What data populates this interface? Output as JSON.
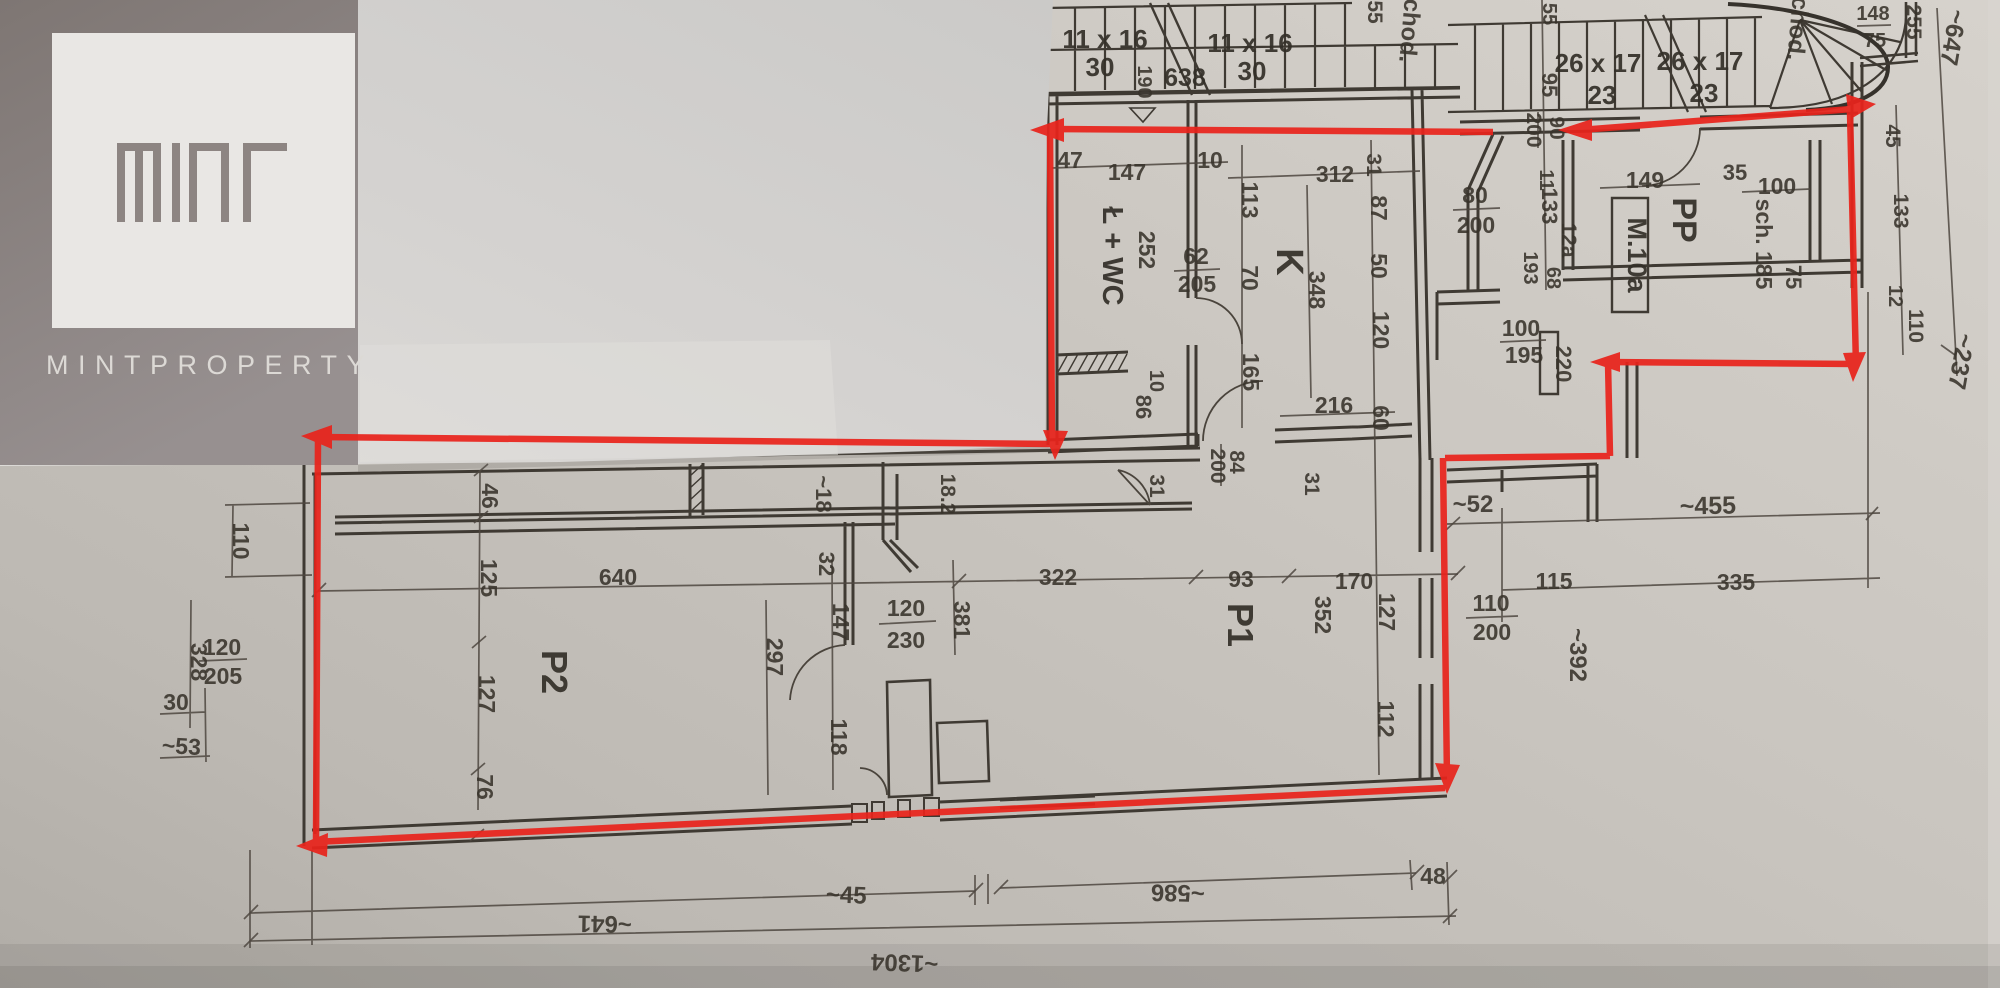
{
  "brand": {
    "wordmark": "MINTPROPERTY",
    "logo_name": "MINT"
  },
  "colors": {
    "annotation_red": "#e8241c",
    "ink": "#38332b",
    "paper": "#c8c4be",
    "overlay_sheet": "#d5d3d0",
    "logo_backdrop": "#8b8280",
    "logo_square": "#e9e7e4"
  },
  "plan": {
    "rooms": {
      "p1": "P1",
      "p2": "P2",
      "k": "K",
      "lwc": "Ł + WC",
      "pp": "PP",
      "m10a": "M.10a",
      "sch": "sch. 185"
    },
    "stairs": {
      "s11": "11 x 16",
      "t30": "30",
      "s26": "26 x 17",
      "t23": "23",
      "lvl": "638",
      "r190": "190",
      "chod": "chod."
    },
    "dims": {
      "d10": "10",
      "d11": "11",
      "d12": "12",
      "d12a": "12a",
      "d18": "~18",
      "d18_2": "18.2",
      "d30": "30",
      "d31": "31",
      "d32": "32",
      "d35": "35",
      "d45": "45",
      "d45b": "~45",
      "d46": "46",
      "d47": "47",
      "d48": "48",
      "d50": "50",
      "d52": "~52",
      "d53": "~53",
      "d55": "55",
      "d60": "60",
      "d62": "62",
      "d68": "68",
      "d70": "70",
      "d75": "75",
      "d76": "76",
      "d80": "80",
      "d84": "84",
      "d86": "86",
      "d87": "87",
      "d90": "90",
      "d93": "93",
      "d95": "95",
      "d100": "100",
      "d110": "110",
      "d112": "112",
      "d113": "113",
      "d115": "115",
      "d118": "118",
      "d120": "120",
      "d125": "125",
      "d127": "127",
      "d133": "133",
      "d147": "147",
      "d148": "148",
      "d149": "149",
      "d165": "165",
      "d170": "170",
      "d193": "193",
      "d195": "195",
      "d200": "200",
      "d205": "205",
      "d216": "216",
      "d220": "220",
      "d230": "230",
      "d237": "~237",
      "d252": "252",
      "d255": "255",
      "d297": "297",
      "d312": "312",
      "d322": "322",
      "d328": "328",
      "d335": "335",
      "d348": "348",
      "d352": "352",
      "d381": "381",
      "d392": "~392",
      "d455": "~455",
      "d586": "~586",
      "d640": "640",
      "d641": "~641",
      "d647": "~647",
      "d1304": "~1304"
    }
  }
}
